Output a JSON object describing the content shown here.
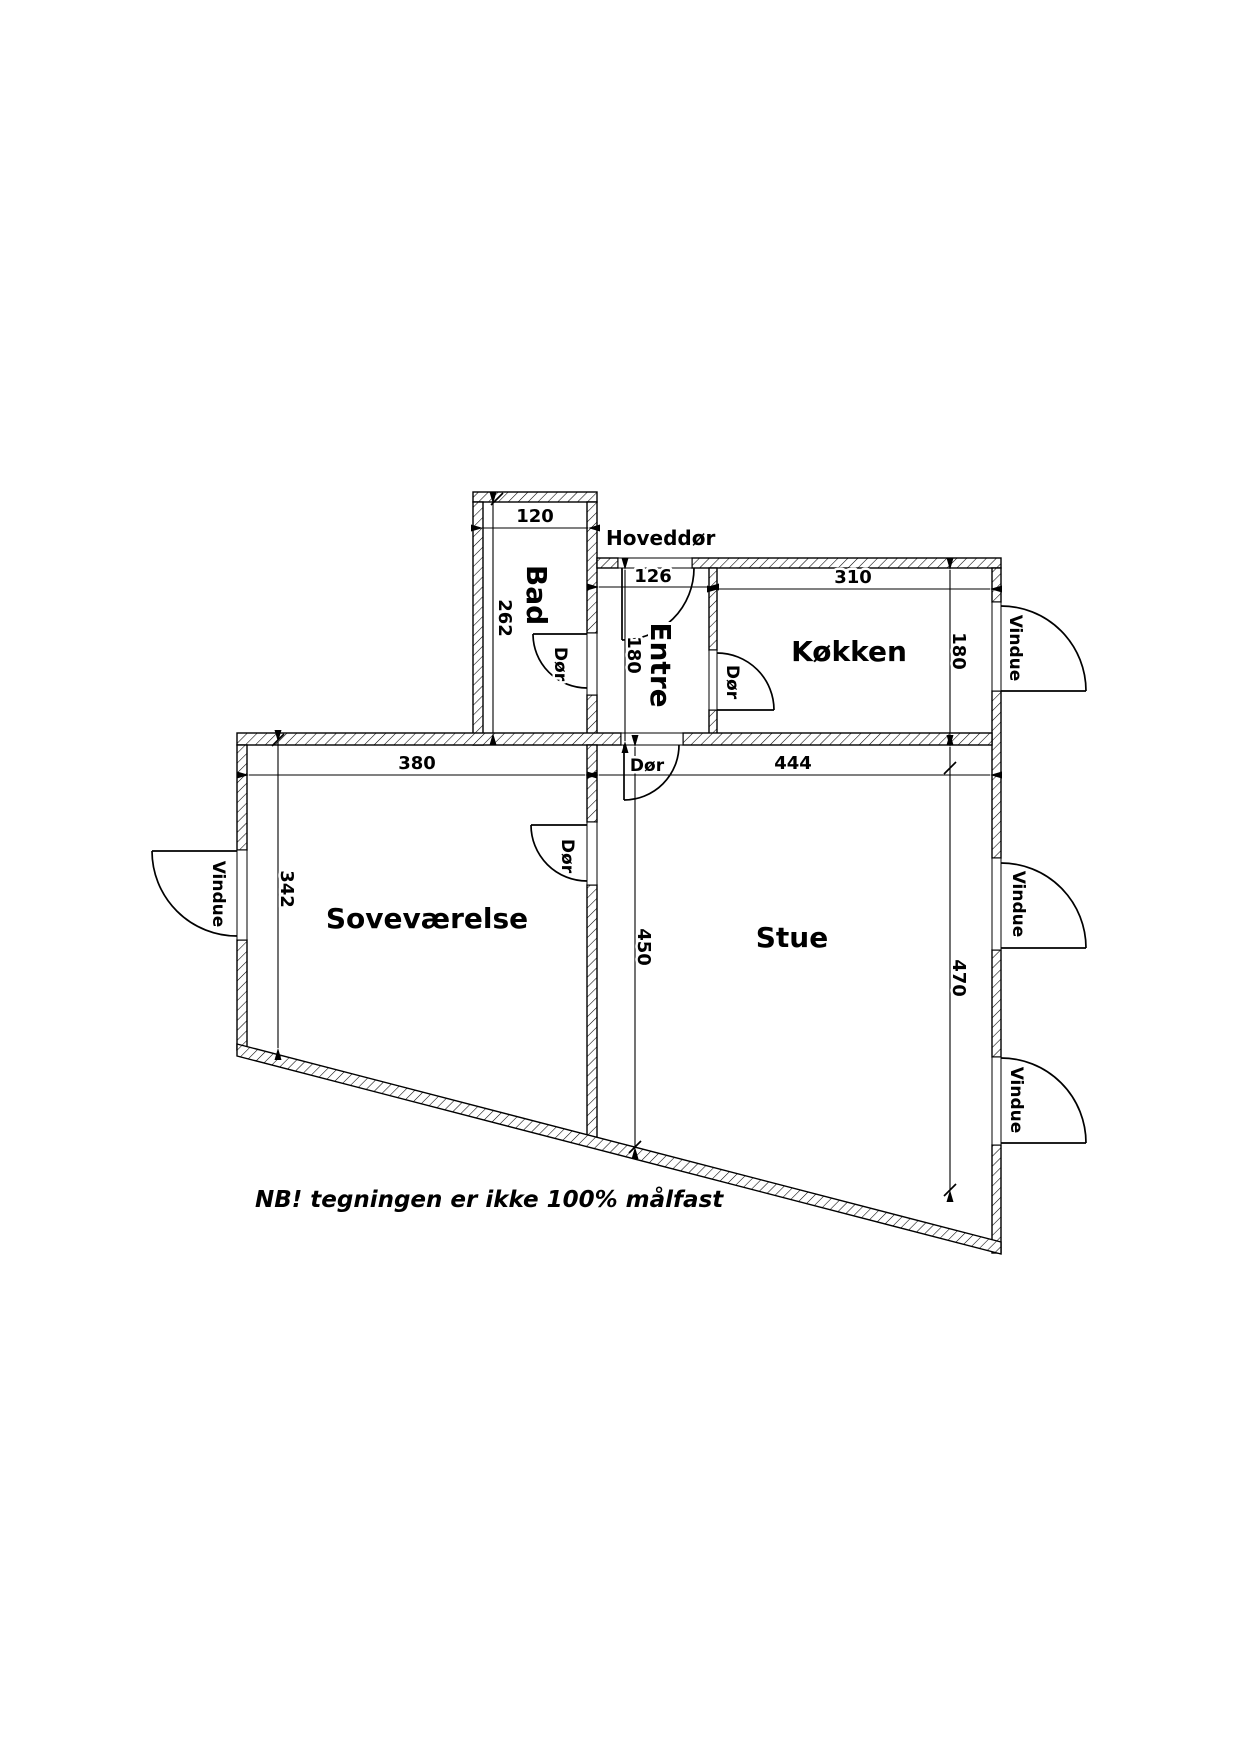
{
  "note": "NB! tegningen er ikke 100% målfast",
  "labels": {
    "hoveddoer": "Hoveddør",
    "doer": "Dør",
    "vindue": "Vindue"
  },
  "rooms": {
    "bad": {
      "name": "Bad",
      "width_cm": "120",
      "depth_cm": "262"
    },
    "entre": {
      "name": "Entre",
      "width_cm": "126",
      "depth_cm": "180"
    },
    "koekken": {
      "name": "Køkken",
      "width_cm": "310",
      "depth_cm": "180"
    },
    "sovevaerelse": {
      "name": "Soveværelse",
      "width_cm": "380",
      "depth_cm": "342"
    },
    "stue": {
      "name": "Stue",
      "width_cm": "444",
      "depth_left_cm": "450",
      "depth_right_cm": "470"
    }
  }
}
